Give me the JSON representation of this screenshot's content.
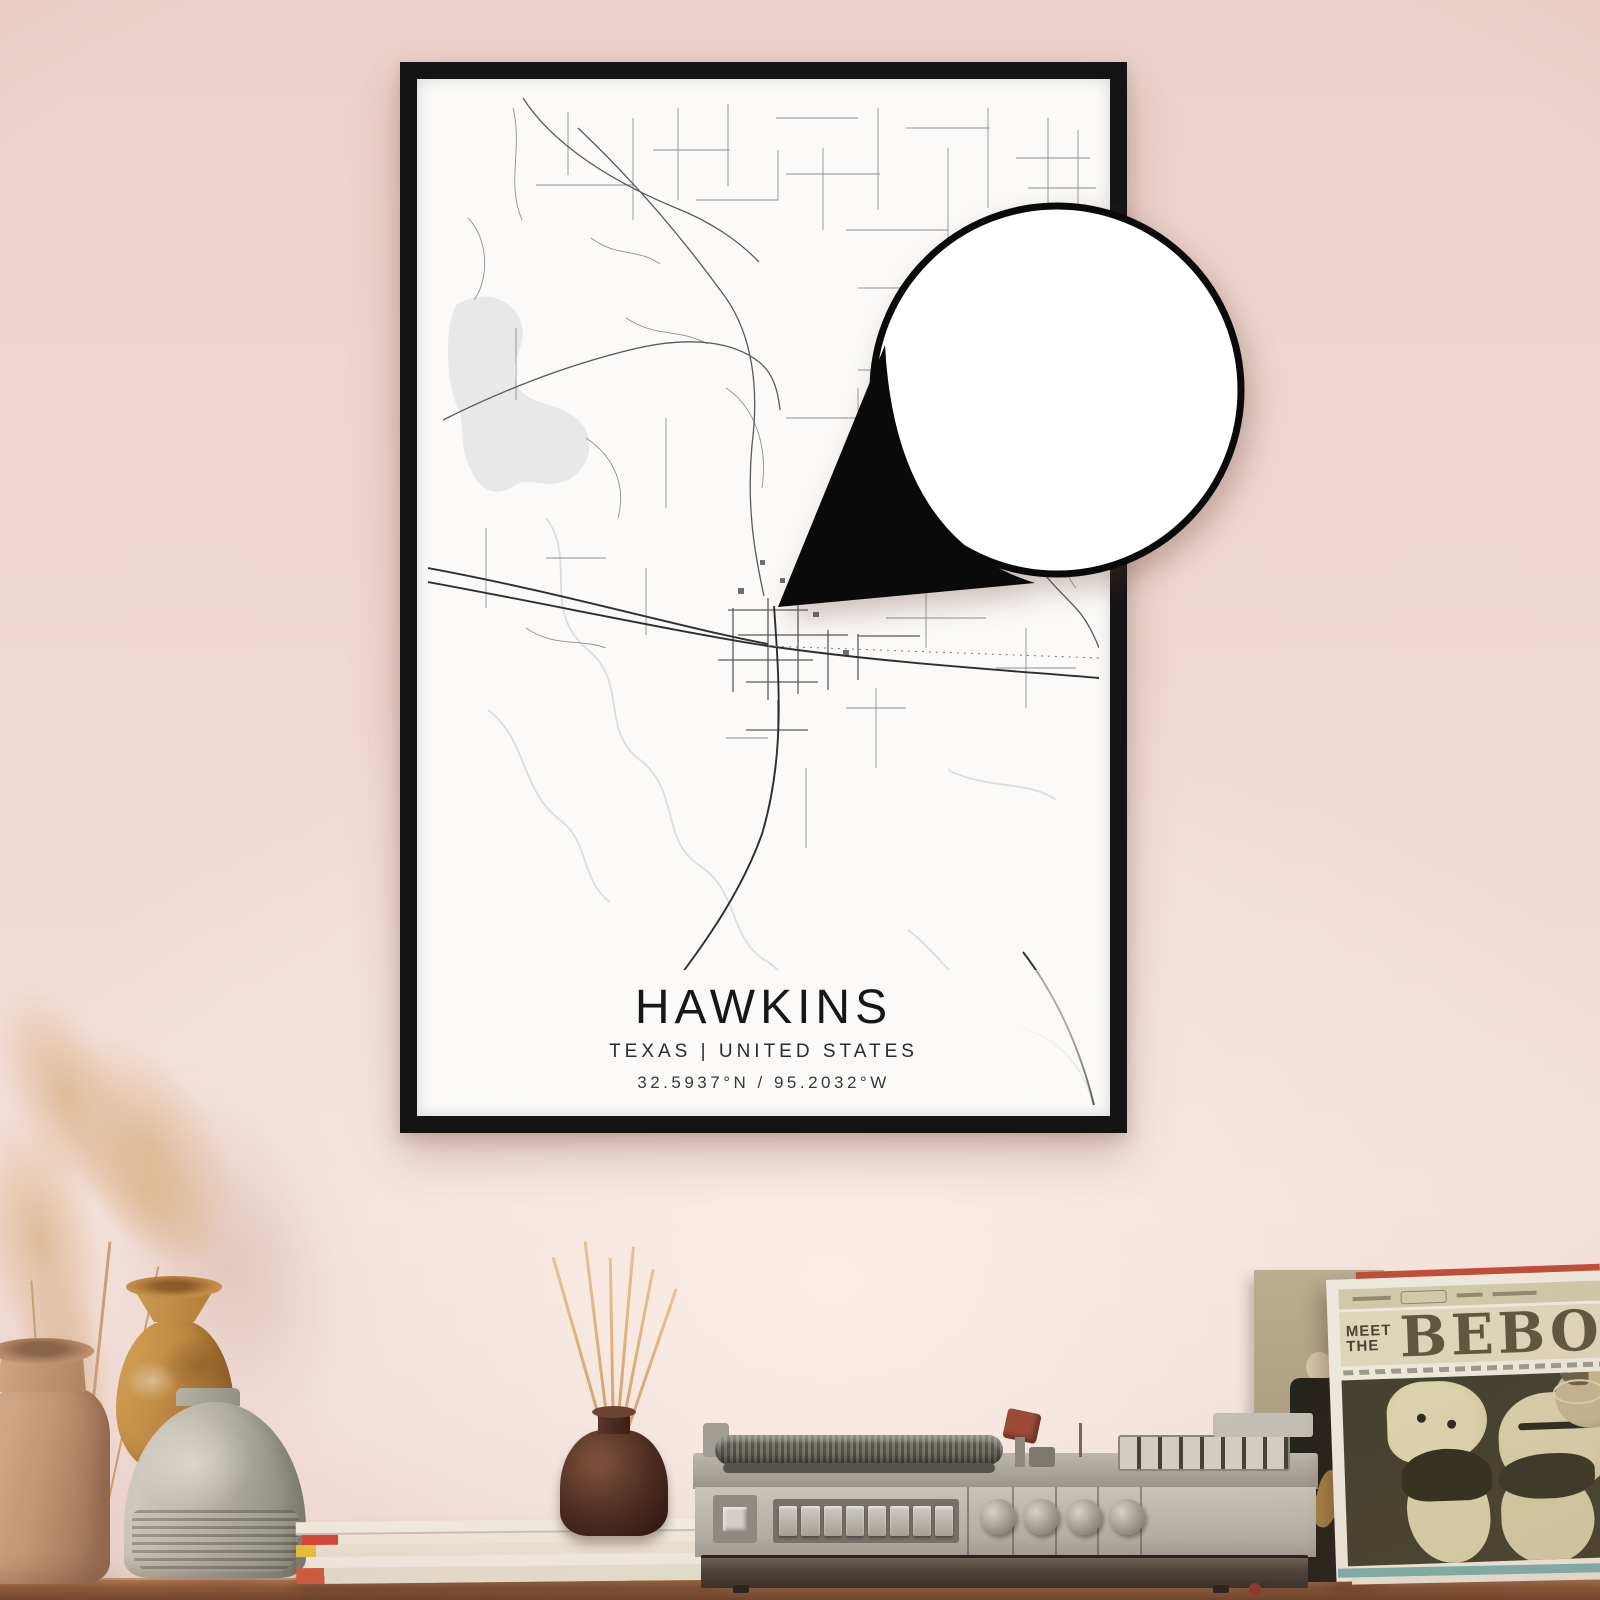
{
  "poster": {
    "title": "HAWKINS",
    "region_line": "TEXAS | UNITED STATES",
    "coordinates_line": "32.5937°N / 95.2032°W",
    "frame_color": "#141414",
    "paper_color": "#fbfaf8",
    "map_road_color": "#2e2e2e",
    "map_water_color": "#e8e8e8",
    "callout_outline_color": "#0a0a0a"
  },
  "album_sleeve": {
    "title_line1": "MEET",
    "title_line2": "THE",
    "title_main": "BEBOP",
    "cover_background": "#45422f",
    "cover_art_color": "#d8cfa9"
  },
  "room": {
    "wall_color": "#efd8d0",
    "shelf_color": "#8a5a3a"
  }
}
